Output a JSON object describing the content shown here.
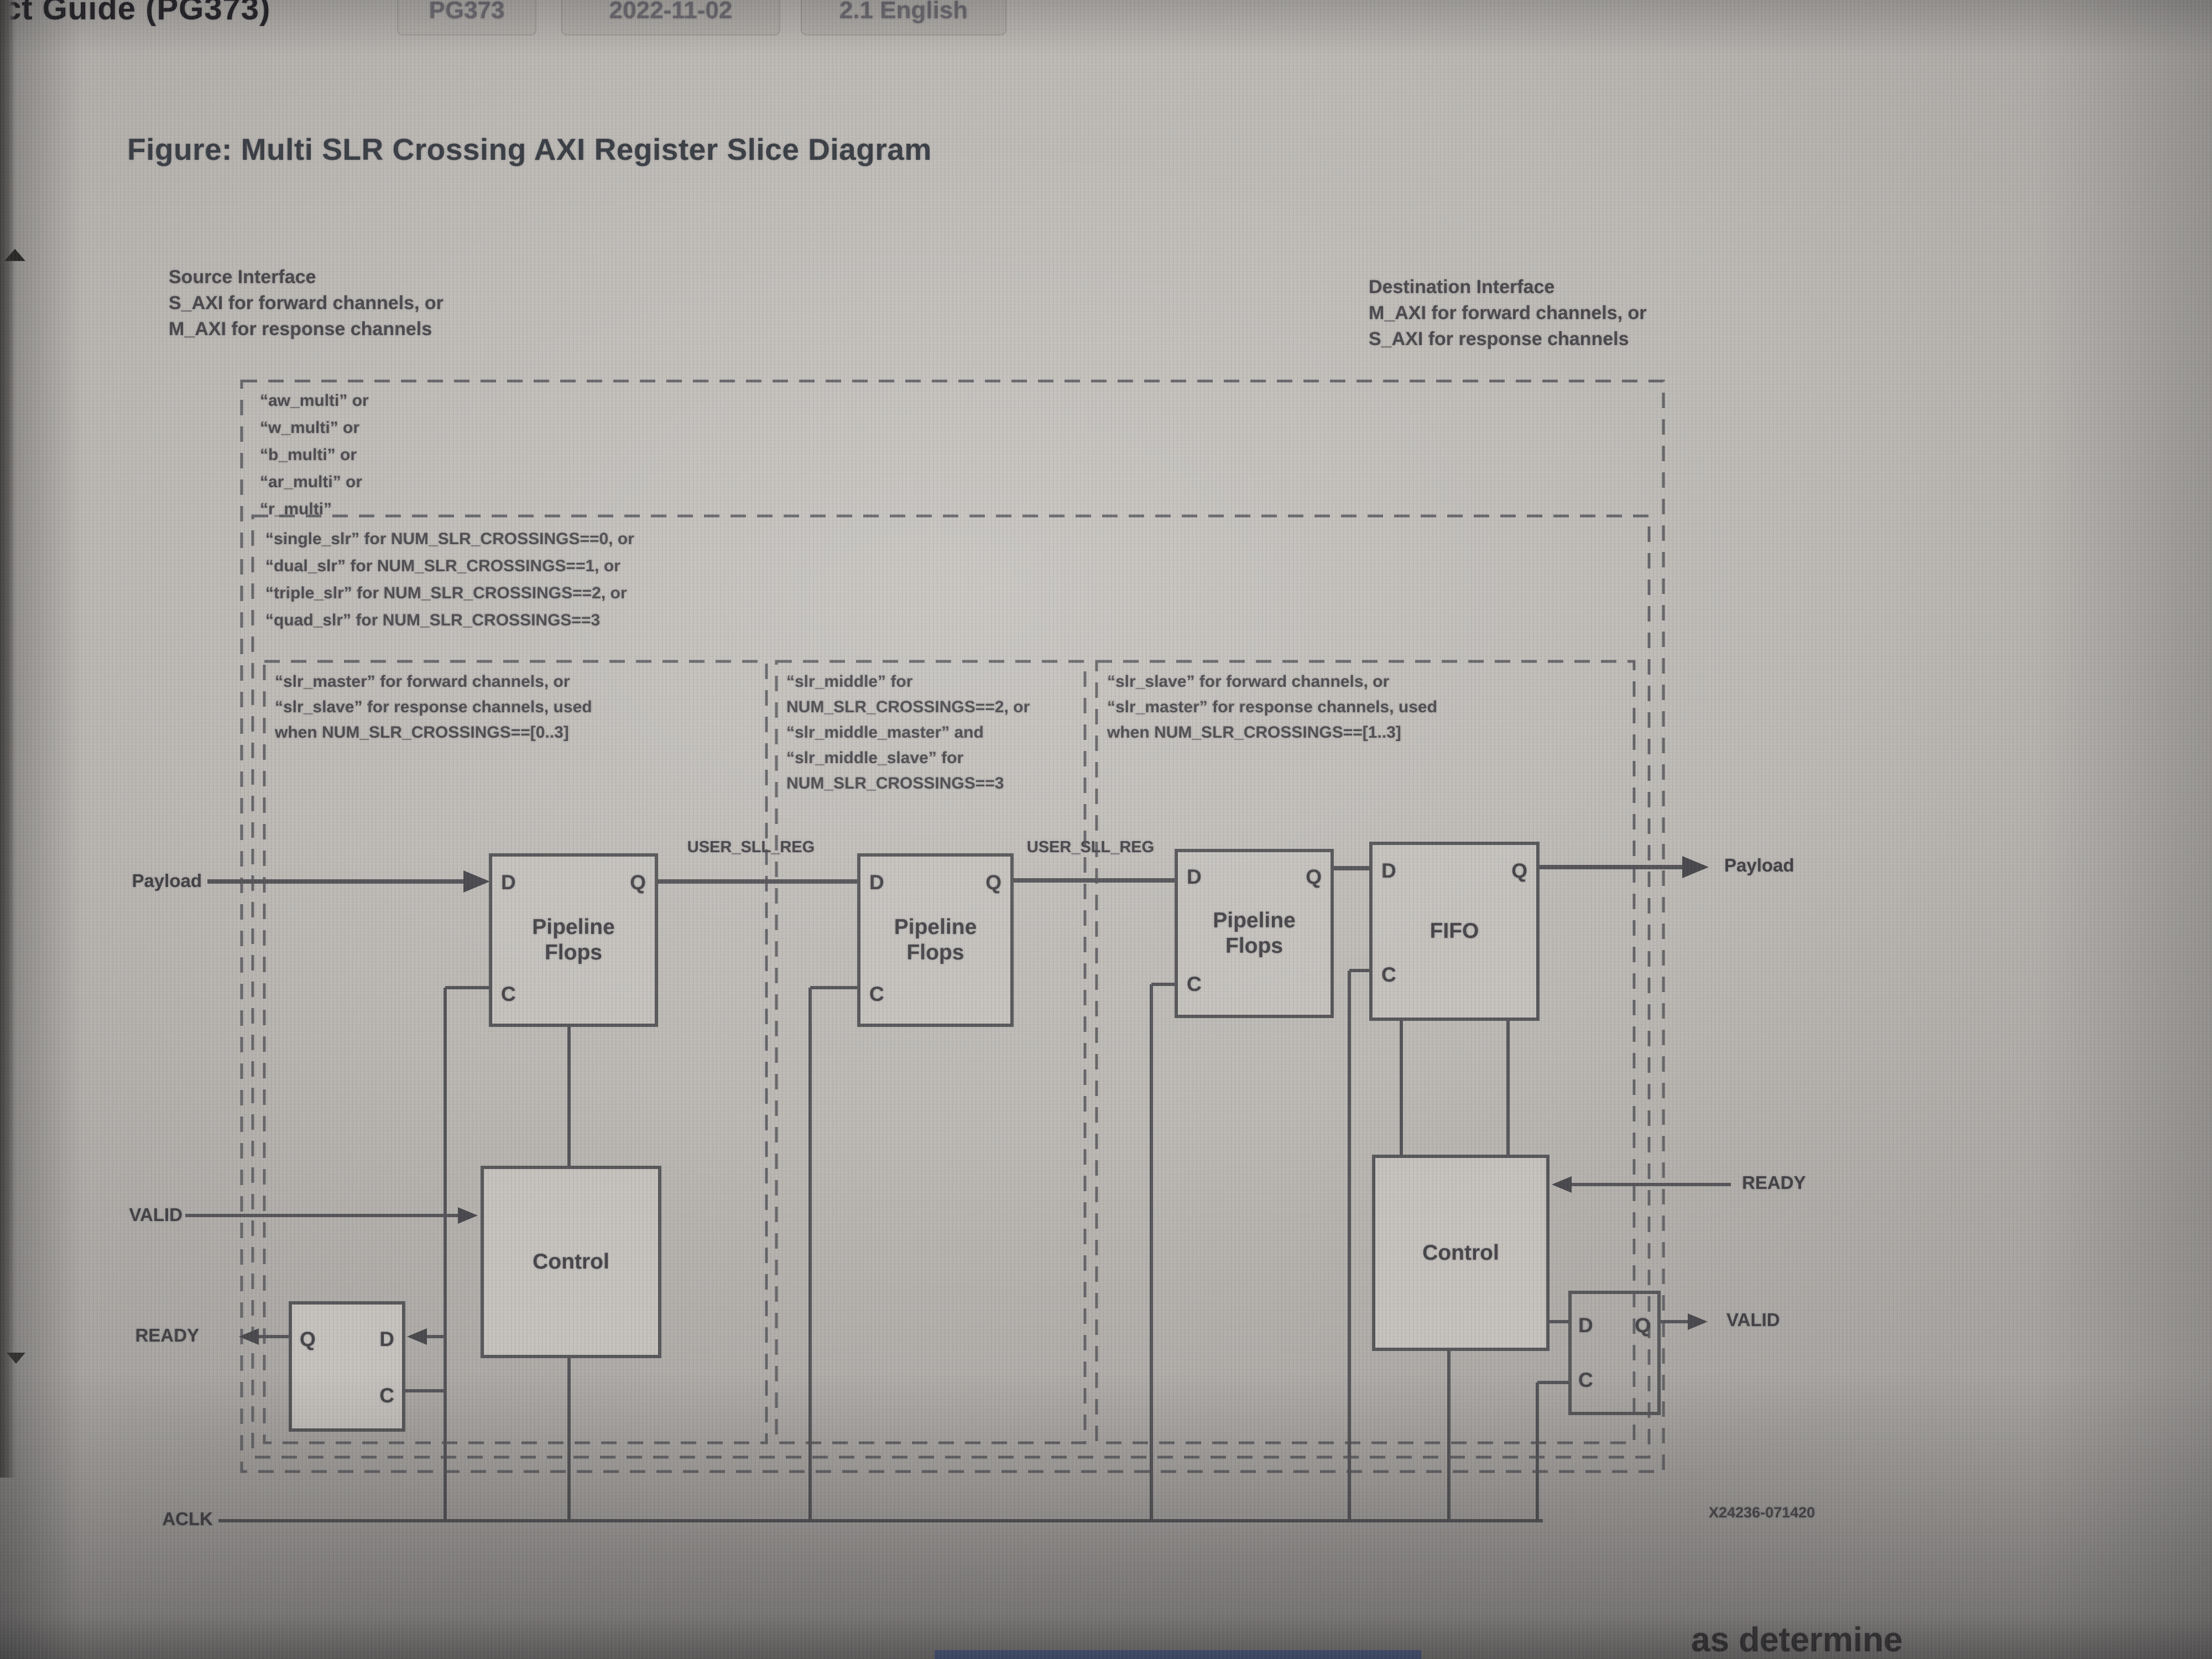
{
  "header": {
    "doc_title": "ct Guide (PG373)",
    "badges": [
      "PG373",
      "2022-11-02",
      "2.1 English"
    ]
  },
  "figure": {
    "title": "Figure: Multi SLR Crossing AXI Register Slice Diagram",
    "number": "X24236-071420"
  },
  "interfaces": {
    "source": {
      "line1": "Source Interface",
      "line2": "S_AXI for forward channels, or",
      "line3": "M_AXI for response channels"
    },
    "destination": {
      "line1": "Destination Interface",
      "line2": "M_AXI for forward channels, or",
      "line3": "S_AXI for response channels"
    }
  },
  "annotations": {
    "multi": [
      "“aw_multi” or",
      "“w_multi” or",
      "“b_multi” or",
      "“ar_multi” or",
      "“r_multi”"
    ],
    "slr_levels": [
      "“single_slr” for NUM_SLR_CROSSINGS==0, or",
      "“dual_slr” for NUM_SLR_CROSSINGS==1, or",
      "“triple_slr” for NUM_SLR_CROSSINGS==2, or",
      "“quad_slr” for NUM_SLR_CROSSINGS==3"
    ],
    "master_col": [
      "“slr_master” for forward channels, or",
      "“slr_slave” for response channels, used",
      "when NUM_SLR_CROSSINGS==[0..3]"
    ],
    "middle_col": [
      "“slr_middle” for",
      "NUM_SLR_CROSSINGS==2, or",
      "“slr_middle_master” and",
      "“slr_middle_slave” for",
      "NUM_SLR_CROSSINGS==3"
    ],
    "slave_col": [
      "“slr_slave” for forward channels, or",
      "“slr_master” for response channels, used",
      "when NUM_SLR_CROSSINGS==[1..3]"
    ]
  },
  "signals": {
    "payload_in": "Payload",
    "payload_out": "Payload",
    "valid_in": "VALID",
    "valid_out": "VALID",
    "ready_out": "READY",
    "ready_in": "READY",
    "aclk": "ACLK",
    "user_sll_reg_1": "USER_SLL_REG",
    "user_sll_reg_2": "USER_SLL_REG"
  },
  "blocks": {
    "pf_line1": "Pipeline",
    "pf_line2": "Flops",
    "fifo": "FIFO",
    "control": "Control",
    "port_d": "D",
    "port_q": "Q",
    "port_c": "C"
  },
  "bottom_fragment": "as determine",
  "colors": {
    "page_bg": "#bdbab6",
    "line": "#56565a",
    "dashed": "#66666a",
    "text": "#4c4b4f",
    "chip_bg": "#b3b0ac",
    "blue_bar": "#4f6cb5"
  }
}
